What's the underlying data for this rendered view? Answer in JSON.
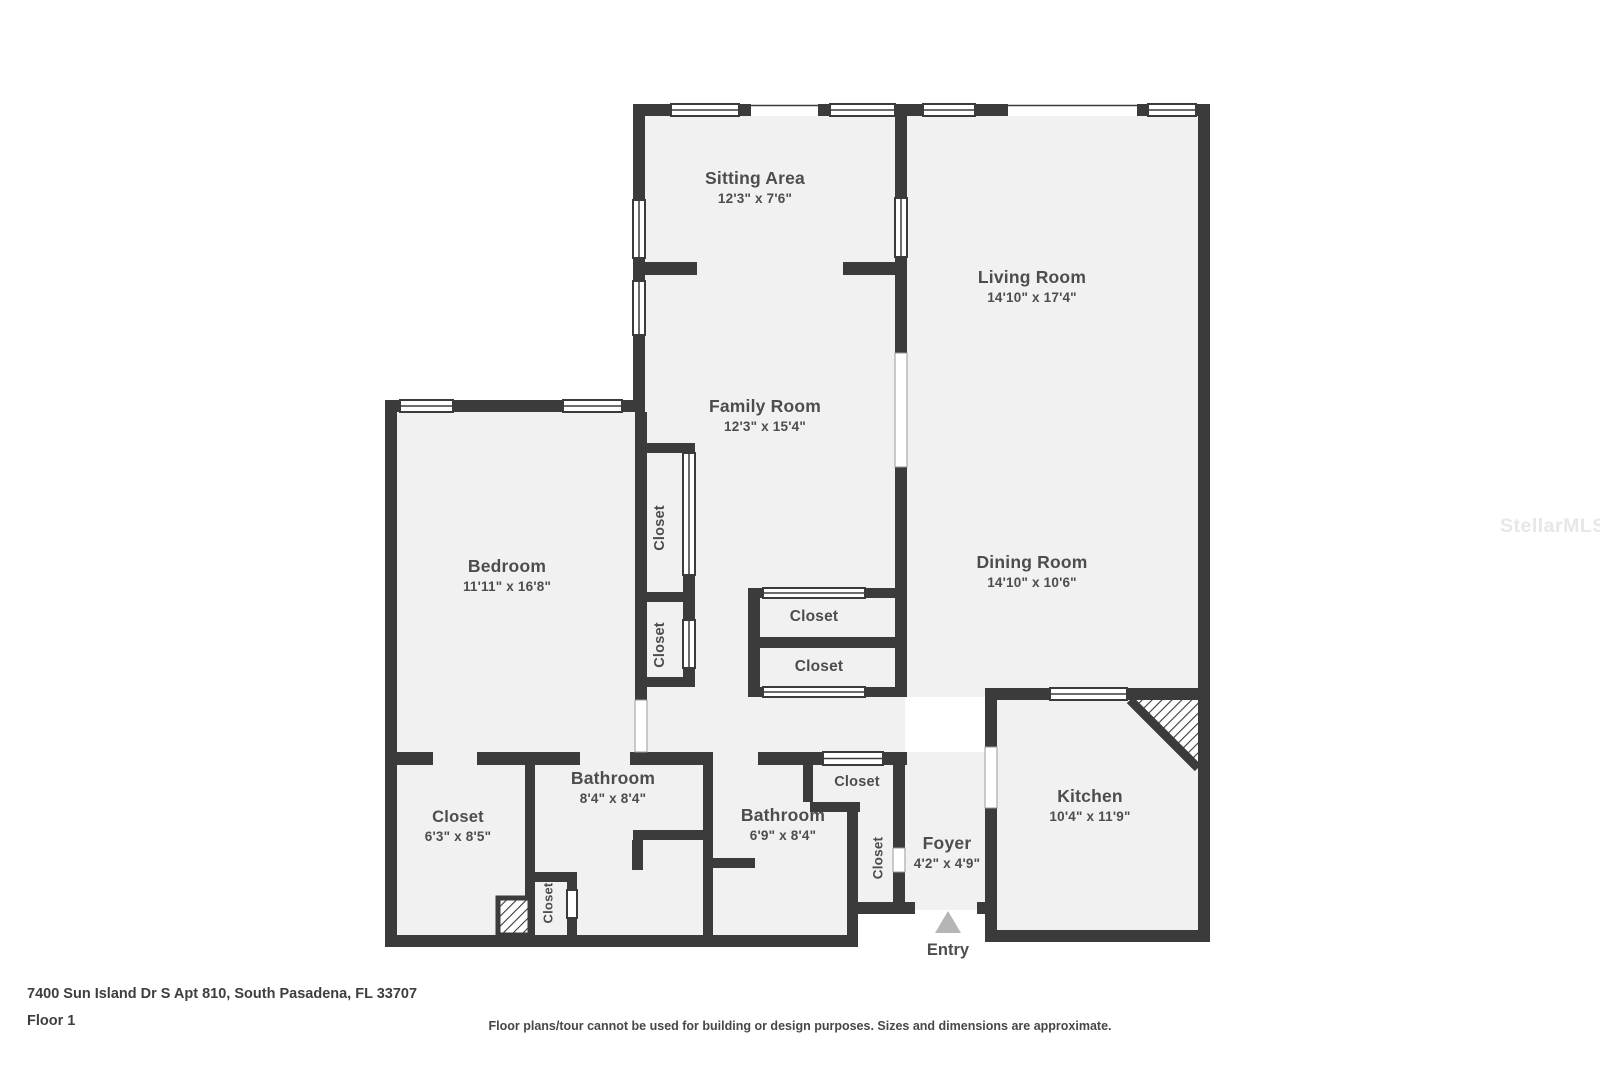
{
  "page": {
    "address": "7400 Sun Island Dr S Apt 810, South Pasadena, FL 33707",
    "floor_label": "Floor 1",
    "disclaimer": "Floor plans/tour cannot be used for building or design purposes. Sizes and dimensions are approximate.",
    "watermark": "StellarMLS"
  },
  "rooms": {
    "sitting": {
      "name": "Sitting Area",
      "dims": "12'3\" x 7'6\""
    },
    "living": {
      "name": "Living Room",
      "dims": "14'10\" x 17'4\""
    },
    "family": {
      "name": "Family Room",
      "dims": "12'3\" x 15'4\""
    },
    "bedroom": {
      "name": "Bedroom",
      "dims": "11'11\" x 16'8\""
    },
    "dining": {
      "name": "Dining Room",
      "dims": "14'10\" x 10'6\""
    },
    "kitchen": {
      "name": "Kitchen",
      "dims": "10'4\" x 11'9\""
    },
    "foyer": {
      "name": "Foyer",
      "dims": "4'2\" x 4'9\""
    },
    "hall_closet": {
      "name": "Closet",
      "dims": "6'3\" x 8'5\""
    },
    "bathroom1": {
      "name": "Bathroom",
      "dims": "8'4\" x 8'4\""
    },
    "bathroom2": {
      "name": "Bathroom",
      "dims": "6'9\" x 8'4\""
    }
  },
  "labels": {
    "closet": "Closet",
    "entry": "Entry"
  },
  "colors": {
    "wall": "#3b3b3b",
    "floor": "#f1f1f1",
    "label": "#4d4d4d",
    "entry_arrow": "#b5b5b5",
    "watermark": "#e7e7e7"
  }
}
